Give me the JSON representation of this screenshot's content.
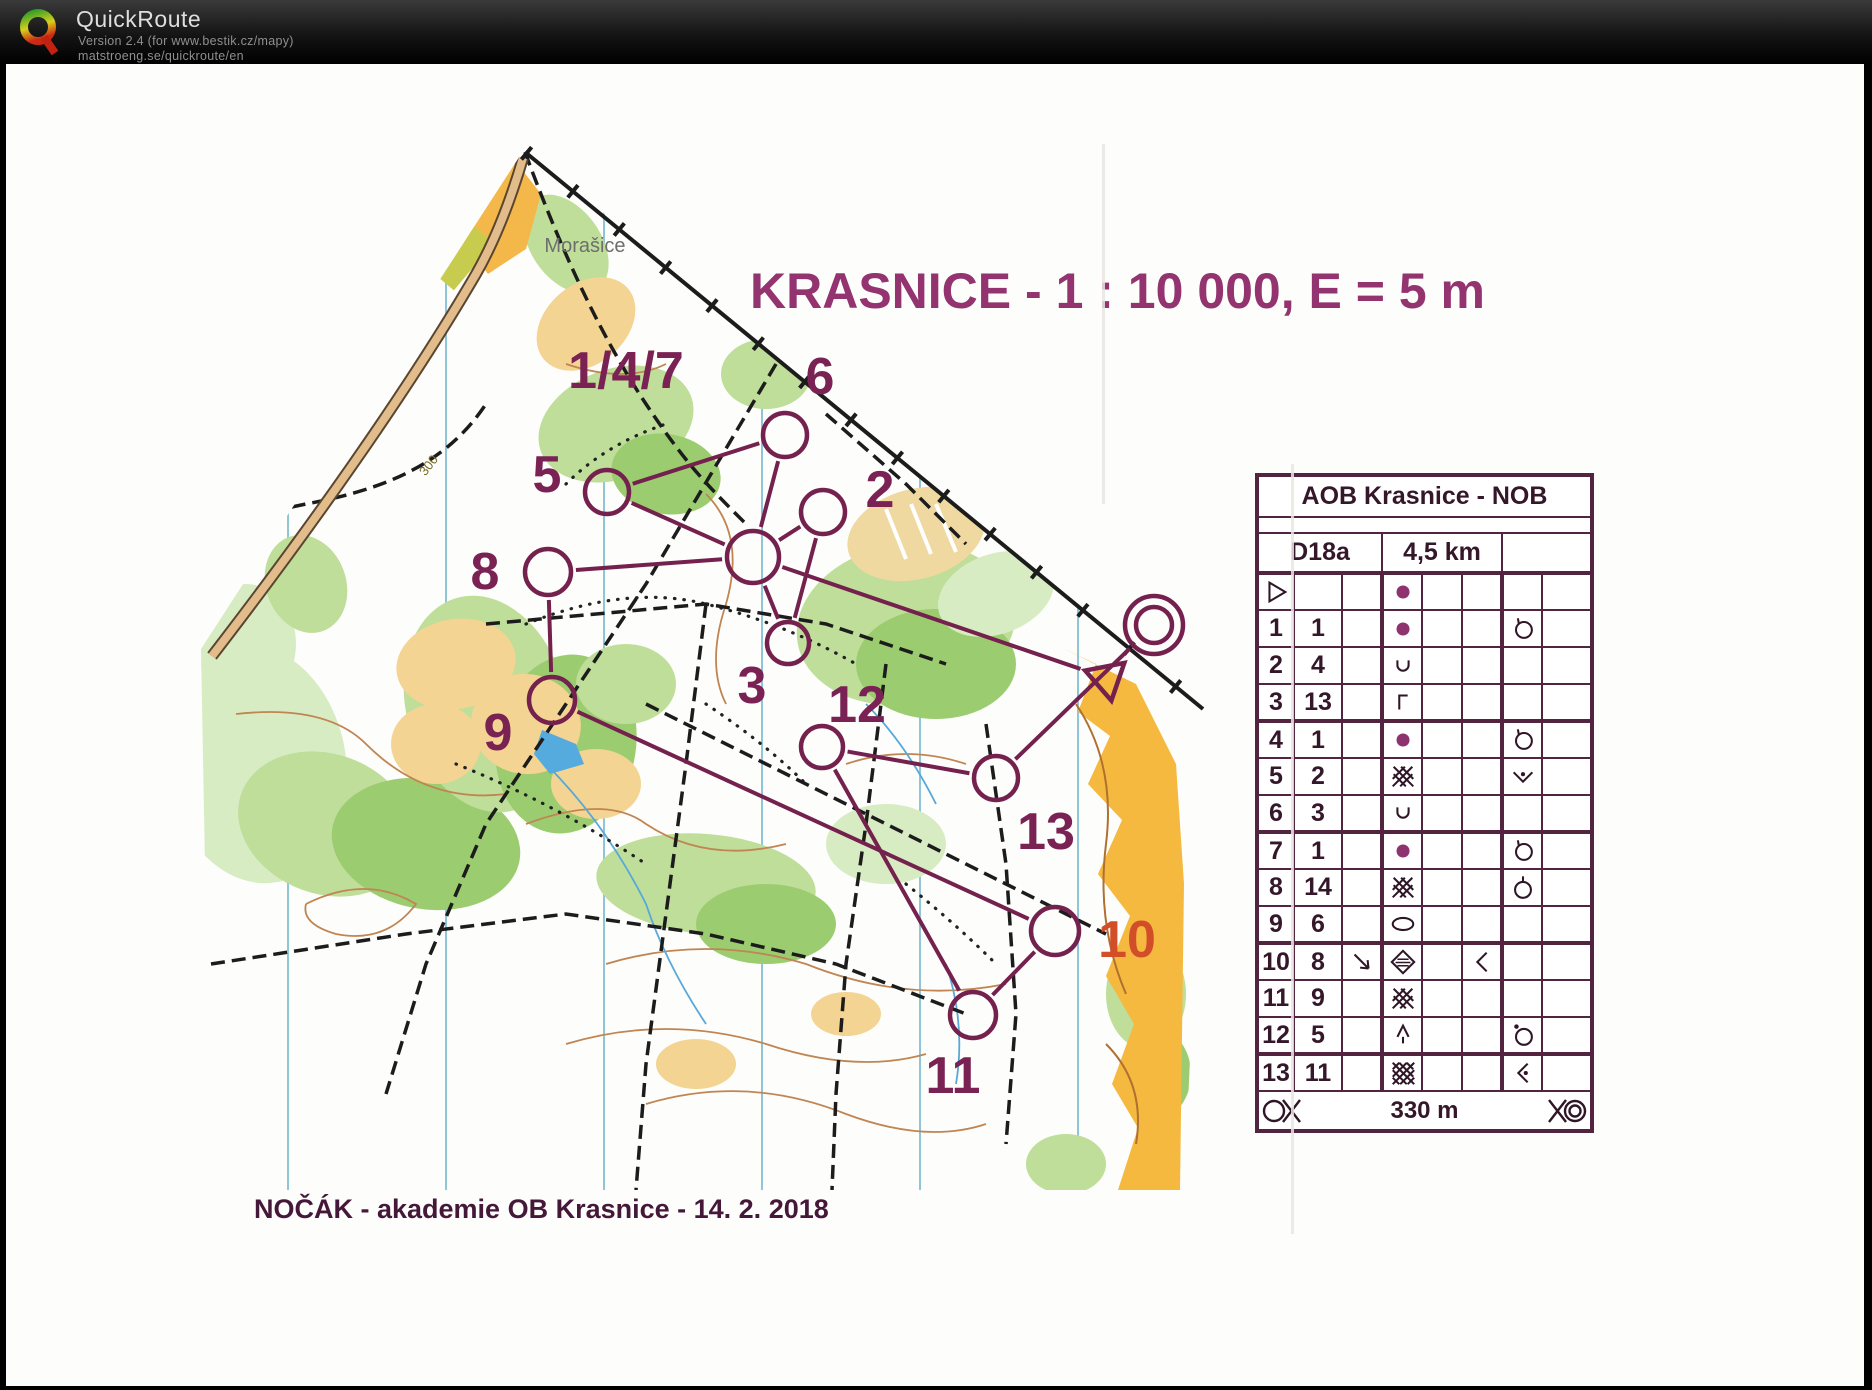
{
  "app": {
    "name": "QuickRoute",
    "version_line": "Version 2.4 (for www.bestik.cz/mapy)",
    "site_line": "matstroeng.se/quickroute/en"
  },
  "map": {
    "title": "KRASNICE - 1 : 10 000, E = 5 m",
    "place_label": "Morašice",
    "contour_label": "300",
    "footer_text": "NOČÁK - akademie OB Krasnice - 14. 2. 2018",
    "colors": {
      "course": "#74214e",
      "control_label": "#7a2253",
      "control_label_alt": "#d14e28",
      "title": "#93336f"
    }
  },
  "course": {
    "start": {
      "x": 1101,
      "y": 614,
      "size": 23
    },
    "finish": {
      "x": 1148,
      "y": 561,
      "r_outer": 29,
      "r_inner": 18
    },
    "controls": [
      {
        "id": "147",
        "x": 747,
        "y": 493,
        "r": 26,
        "label": "1/4/7",
        "label_x": 620,
        "label_y": 307
      },
      {
        "id": "2",
        "x": 817,
        "y": 448,
        "r": 22,
        "label": "2",
        "label_x": 874,
        "label_y": 426
      },
      {
        "id": "3",
        "x": 782,
        "y": 579,
        "r": 21,
        "label": "3",
        "label_x": 746,
        "label_y": 622
      },
      {
        "id": "5",
        "x": 601,
        "y": 428,
        "r": 22,
        "label": "5",
        "label_x": 541,
        "label_y": 411
      },
      {
        "id": "6",
        "x": 779,
        "y": 371,
        "r": 22,
        "label": "6",
        "label_x": 814,
        "label_y": 313
      },
      {
        "id": "8",
        "x": 542,
        "y": 508,
        "r": 23,
        "label": "8",
        "label_x": 479,
        "label_y": 508
      },
      {
        "id": "9",
        "x": 546,
        "y": 636,
        "r": 23,
        "label": "9",
        "label_x": 492,
        "label_y": 669
      },
      {
        "id": "10",
        "x": 1049,
        "y": 867,
        "r": 24,
        "label": "10",
        "label_x": 1121,
        "label_y": 876,
        "alt_color": true
      },
      {
        "id": "11",
        "x": 967,
        "y": 951,
        "r": 23,
        "label": "11",
        "label_x": 947,
        "label_y": 1012
      },
      {
        "id": "12",
        "x": 816,
        "y": 683,
        "r": 21,
        "label": "12",
        "label_x": 851,
        "label_y": 641
      },
      {
        "id": "13",
        "x": 990,
        "y": 714,
        "r": 22,
        "label": "13",
        "label_x": 1040,
        "label_y": 768
      }
    ],
    "sequence": [
      "start",
      "147",
      "2",
      "3",
      "147",
      "5",
      "6",
      "147",
      "8",
      "9",
      "10",
      "11",
      "12",
      "13",
      "finish"
    ]
  },
  "control_table": {
    "title": "AOB Krasnice - NOB",
    "class_name": "D18a",
    "distance": "4,5 km",
    "finish_distance": "330 m",
    "rows": [
      {
        "a": "start",
        "b": "",
        "symbols": {
          "d": "dot"
        }
      },
      {
        "a": "1",
        "b": "1",
        "symbols": {
          "d": "dot",
          "g": "circle-tick"
        }
      },
      {
        "a": "2",
        "b": "4",
        "symbols": {
          "d": "u-cup"
        }
      },
      {
        "a": "3",
        "b": "13",
        "symbols": {
          "d": "gamma"
        }
      },
      {
        "a": "4",
        "b": "1",
        "symbols": {
          "d": "dot",
          "g": "circle-tick"
        }
      },
      {
        "a": "5",
        "b": "2",
        "symbols": {
          "d": "crosshatch",
          "g": "v-dot"
        }
      },
      {
        "a": "6",
        "b": "3",
        "symbols": {
          "d": "u-cup"
        }
      },
      {
        "a": "7",
        "b": "1",
        "symbols": {
          "d": "dot",
          "g": "circle-tick"
        }
      },
      {
        "a": "8",
        "b": "14",
        "symbols": {
          "d": "crosshatch",
          "g": "circle-tick-top"
        }
      },
      {
        "a": "9",
        "b": "6",
        "symbols": {
          "d": "ellipse"
        }
      },
      {
        "a": "10",
        "b": "8",
        "symbols": {
          "c": "arrow-se",
          "d": "marsh",
          "f": "angle-left"
        }
      },
      {
        "a": "11",
        "b": "9",
        "symbols": {
          "d": "crosshatch"
        }
      },
      {
        "a": "12",
        "b": "5",
        "symbols": {
          "d": "tree",
          "g": "circle-dot"
        }
      },
      {
        "a": "13",
        "b": "11",
        "symbols": {
          "d": "crosshatch-dense",
          "g": "angle-left-dot"
        }
      }
    ]
  }
}
